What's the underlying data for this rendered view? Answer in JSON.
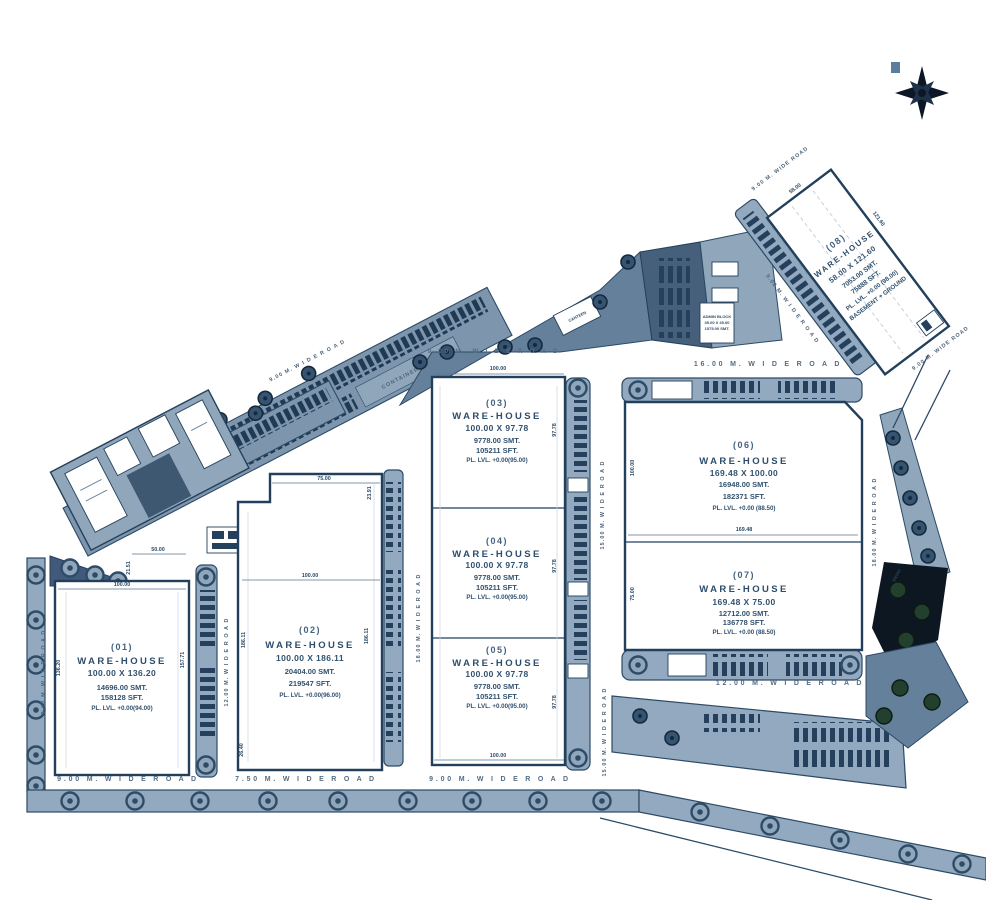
{
  "warehouses": [
    {
      "num": "(01)",
      "title": "WARE-HOUSE",
      "size": "100.00 X 136.20",
      "smt": "14696.00 SMT.",
      "sft": "158128 SFT.",
      "level": "PL. LVL. +0.00(94.00)"
    },
    {
      "num": "(02)",
      "title": "WARE-HOUSE",
      "size": "100.00 X 186.11",
      "smt": "20404.00 SMT.",
      "sft": "219547 SFT.",
      "level": "PL. LVL. +0.00(96.00)"
    },
    {
      "num": "(03)",
      "title": "WARE-HOUSE",
      "size": "100.00 X 97.78",
      "smt": "9778.00 SMT.",
      "sft": "105211 SFT.",
      "level": "PL. LVL. +0.00(95.00)"
    },
    {
      "num": "(04)",
      "title": "WARE-HOUSE",
      "size": "100.00 X 97.78",
      "smt": "9778.00 SMT.",
      "sft": "105211 SFT.",
      "level": "PL. LVL. +0.00(95.00)"
    },
    {
      "num": "(05)",
      "title": "WARE-HOUSE",
      "size": "100.00 X 97.78",
      "smt": "9778.00 SMT.",
      "sft": "105211 SFT.",
      "level": "PL. LVL. +0.00(95.00)"
    },
    {
      "num": "(06)",
      "title": "WARE-HOUSE",
      "size": "169.48 X 100.00",
      "smt": "16948.00 SMT.",
      "sft": "182371 SFT.",
      "level": "PL. LVL. +0.00 (88.50)"
    },
    {
      "num": "(07)",
      "title": "WARE-HOUSE",
      "size": "169.48 X 75.00",
      "smt": "12712.00 SMT.",
      "sft": "136778 SFT.",
      "level": "PL. LVL. +0.00 (88.50)"
    },
    {
      "num": "(08)",
      "title": "WARE-HOUSE",
      "size": "58.00 X 121.60",
      "smt": "7053.00 SMT.",
      "sft": "75888 SFT.",
      "level": "PL. LVL. +0.00 (98.00)",
      "extra": "BASEMENT + GROUND"
    }
  ],
  "roads": {
    "left_9m": "9.00 M.  W I D E  R O A D",
    "bottom_9m_wh01": "9.00 M.  W I D E   R O A D",
    "mid_12m": "12.00 M.  W I D E  R O A D",
    "bottom_750m": "7.50 M.  W I D E   R O A D",
    "mid_18m": "18.00 M.  W I D E  R O A D",
    "top_9m_wh03": "9.00 M.  W I D E   R O A D",
    "bottom_9m_wh05": "9.00 M.  W I D E   R O A D",
    "mid_15m_upper": "15.00 M.  W I D E  R O A D",
    "mid_15m_lower": "15.00 M.  W I D E  R O A D",
    "top_16m": "16.00 M.  W I D E   R O A D",
    "bottom_12m": "12.00 M.   W I D E   R O A D",
    "right_18m": "18.00 M.  W I D E  R O A D",
    "wh08_top_9m": "9.00 M. WIDE ROAD",
    "wh08_left_9m": "9.00 M.  W I D E  R O A D",
    "wh08_bottom_9m": "9.00 M. WIDE ROAD",
    "diag_9m": "9.00 M.  W I D E  R O A D"
  },
  "dims": {
    "wh01": {
      "top": "100.00",
      "left": "136.20",
      "right": "157.71",
      "notch_w": "50.00",
      "notch_h": "21.51"
    },
    "wh02": {
      "top": "75.00",
      "right_top": "23.91",
      "mid": "100.00",
      "left": "186.11",
      "right": "186.11",
      "bottom_left": "26.40"
    },
    "wh03": {
      "top": "100.00",
      "right": "97.78"
    },
    "wh04": {
      "right": "97.78"
    },
    "wh05": {
      "right": "97.78",
      "bottom": "100.00"
    },
    "wh06": {
      "left": "100.00",
      "mid": "169.48"
    },
    "wh07": {
      "left": "75.00"
    },
    "wh08": {
      "top": "58.00",
      "side": "121.60"
    }
  },
  "labels": {
    "container_yard": "CONTAINER YARD",
    "admin_1": "ADMIN BLOCK",
    "admin_2": "35.00 X 45.00",
    "admin_3": "1575.00 SMT.",
    "canteen": "CANTEEN",
    "entry": "ENTRY"
  }
}
